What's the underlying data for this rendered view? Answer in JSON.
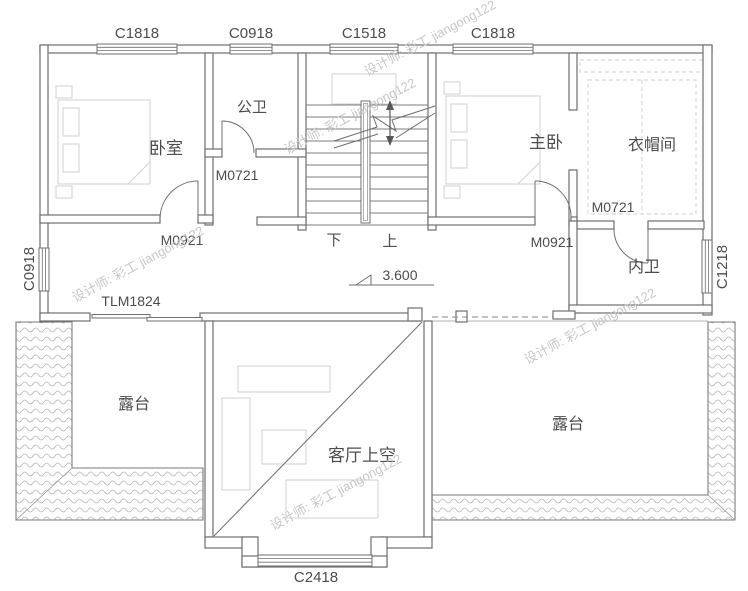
{
  "labels": {
    "win_top_1": "C1818",
    "win_top_2": "C0918",
    "win_top_3": "C1518",
    "win_top_4": "C1818",
    "win_left": "C0918",
    "win_right": "C1218",
    "win_bottom": "C2418",
    "room_bedroom": "卧室",
    "room_public_bath": "公卫",
    "room_master": "主卧",
    "room_cloak": "衣帽间",
    "room_ensuite": "内卫",
    "room_terrace_left": "露台",
    "room_terrace_right": "露台",
    "room_living_void": "客厅上空",
    "door_bath": "M0721",
    "door_bedroom": "M0921",
    "door_master": "M0921",
    "door_ensuite": "M0721",
    "door_sliding": "TLM1824",
    "stair_down": "下",
    "stair_up": "上",
    "level": "3.600",
    "watermark": "设计师: 彩工 jiangong122"
  },
  "colors": {
    "line": "#6f6f6f",
    "text": "#4c4c4c",
    "faint": "#d2d2d2",
    "watermark": "#c7c7c7"
  }
}
